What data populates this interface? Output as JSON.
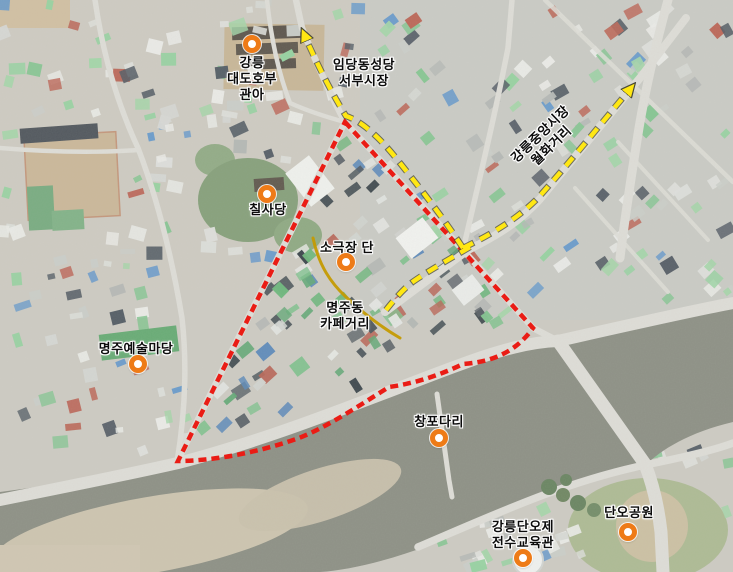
{
  "colors": {
    "boundary": "#ea1c15",
    "route": "#ffe713",
    "cafe_street": "#c49a02",
    "marker": "#ee7b17"
  },
  "annotations": {
    "markers": [
      {
        "name": "gangneung-daedohobu-gwana",
        "x": 252,
        "y": 44
      },
      {
        "name": "chilsadang",
        "x": 267,
        "y": 194
      },
      {
        "name": "sogeukjang-dan",
        "x": 346,
        "y": 262
      },
      {
        "name": "myeongju-art-yard",
        "x": 138,
        "y": 364
      },
      {
        "name": "changpo-bridge",
        "x": 439,
        "y": 438
      },
      {
        "name": "danoje-education-center",
        "x": 523,
        "y": 558
      },
      {
        "name": "dano-park",
        "x": 628,
        "y": 532
      }
    ],
    "labels": [
      {
        "name": "gangneung-daedohobu-gwana",
        "lines": [
          "강릉",
          "대도호부",
          "관아"
        ],
        "x": 252,
        "y": 55,
        "rotate": 0
      },
      {
        "name": "imdang-cathedral-seobu-market",
        "lines": [
          "임당동성당",
          "서부시장"
        ],
        "x": 364,
        "y": 57,
        "rotate": 0
      },
      {
        "name": "chilsadang",
        "lines": [
          "칠사당"
        ],
        "x": 268,
        "y": 202,
        "rotate": 0
      },
      {
        "name": "sogeukjang-dan",
        "lines": [
          "소극장 단"
        ],
        "x": 347,
        "y": 240,
        "rotate": 0
      },
      {
        "name": "myeongjudong-cafe-street",
        "lines": [
          "명주동",
          "카페거리"
        ],
        "x": 345,
        "y": 300,
        "rotate": 0
      },
      {
        "name": "myeongju-art-yard",
        "lines": [
          "명주예술마당"
        ],
        "x": 136,
        "y": 341,
        "rotate": 0
      },
      {
        "name": "changpo-bridge",
        "lines": [
          "창포다리"
        ],
        "x": 439,
        "y": 414,
        "rotate": 0
      },
      {
        "name": "gangneung-danoje-center",
        "lines": [
          "강릉단오제",
          "전수교육관"
        ],
        "x": 523,
        "y": 519,
        "rotate": 0
      },
      {
        "name": "dano-park",
        "lines": [
          "단오공원"
        ],
        "x": 629,
        "y": 505,
        "rotate": 0
      },
      {
        "name": "jungang-market-wolhwa-street",
        "lines": [
          "강릉중앙시장",
          "월화거리"
        ],
        "x": 546,
        "y": 124,
        "rotate": -44
      }
    ]
  },
  "routes": {
    "boundary": {
      "path": "M 345 122 L 533 328 C 516 352 492 362 463 364 C 436 377 411 384 389 387 C 357 407 327 427 299 438 C 257 453 212 461 178 461 Z"
    },
    "route_north": {
      "path": "M 463 248 C 440 213 416 183 396 158 C 374 131 358 120 346 116 C 331 92 316 62 304 34"
    },
    "route_market": {
      "path": "M 463 248 C 492 234 517 219 538 198 C 570 162 600 125 631 88"
    },
    "route_branch": {
      "path": "M 470 247 C 448 260 430 270 414 281 C 404 288 394 300 386 310"
    },
    "cafe_street": {
      "path": "M 313 238 C 319 266 331 283 346 297 C 361 311 381 327 400 338"
    }
  }
}
